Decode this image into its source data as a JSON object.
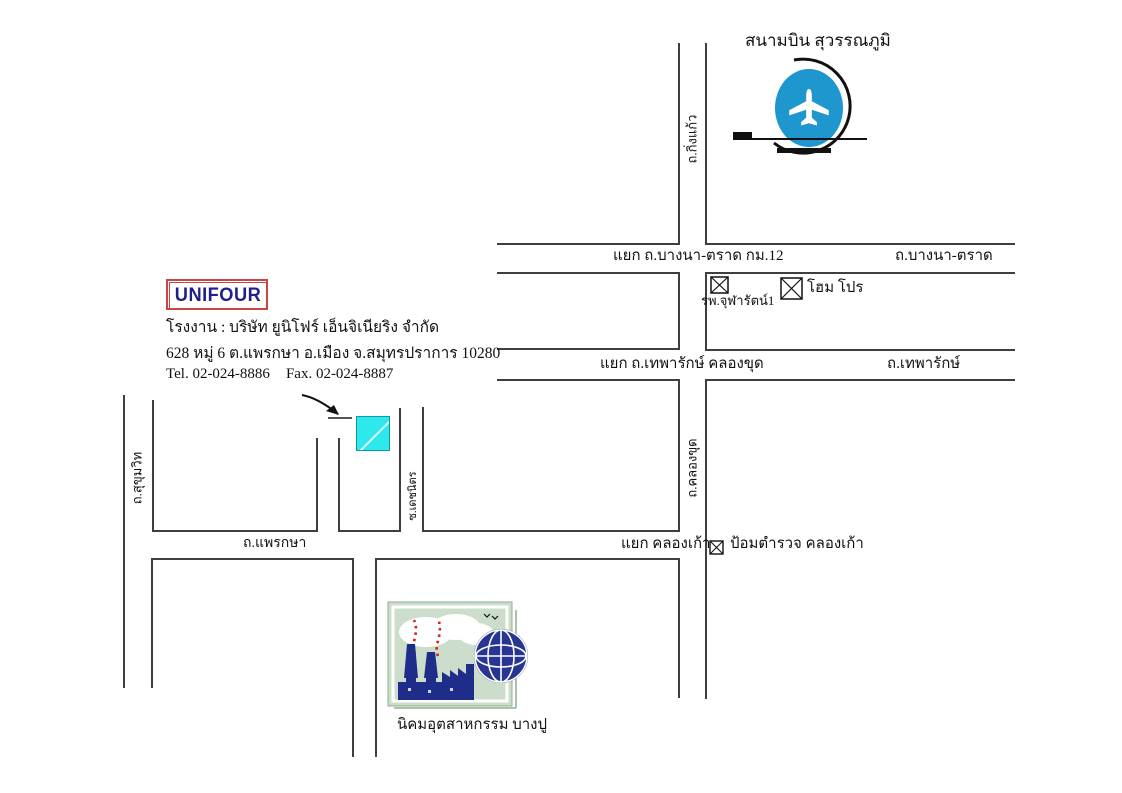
{
  "airport": {
    "label": "สนามบิน สุวรรณภูมิ"
  },
  "roads": {
    "kingkaew": "ถ.กิ่งแก้ว",
    "bangna_junction": "แยก ถ.บางนา-ตราด กม.12",
    "bangna": "ถ.บางนา-ตราด",
    "thepharak_junction": "แยก ถ.เทพารักษ์ คลองขุด",
    "thepharak": "ถ.เทพารักษ์",
    "khlongkhut": "ถ.คลองขุด",
    "sukhumvit": "ถ.สุขุมวิท",
    "soi": "ซ.เดชนิตร",
    "phraeksa": "ถ.แพรกษา",
    "khlongkao_junction": "แยก คลองเก้า"
  },
  "landmarks": {
    "hospital": "รพ.จุฬารัตน์1",
    "homepro": "โฮม โปร",
    "police": "ป้อมตำรวจ คลองเก้า",
    "industrial_estate": "นิคมอุตสาหกรรม บางปู"
  },
  "company": {
    "logo": "UNIFOUR",
    "factory_line": "โรงงาน : บริษัท ยูนิโฟร์ เอ็นจิเนียริง จำกัด",
    "address_line": "628 หมู่ 6 ต.แพรกษา อ.เมือง จ.สมุทรปราการ 10280",
    "tel": "Tel. 02-024-8886",
    "fax": "Fax. 02-024-8887"
  },
  "colors": {
    "line": "#3f3f3f",
    "accent-blue": "#1e96ce",
    "cyan": "#2ee8ee",
    "logo-red": "#cc4444",
    "logo-navy": "#1f1f8f",
    "factory-navy": "#1f2d8a",
    "panel-green": "#ccdecb",
    "smoke-red": "#cc2222"
  }
}
